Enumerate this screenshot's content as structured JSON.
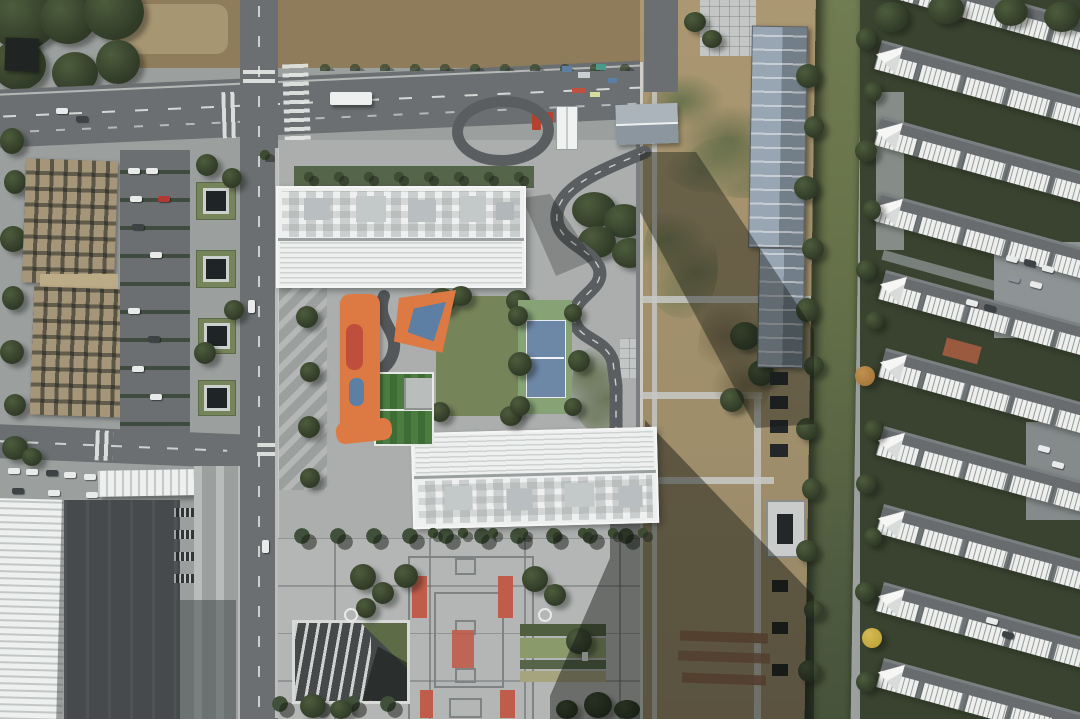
{
  "meta": {
    "type": "aerial-drone-photograph",
    "orientation": "top-down (nadir)",
    "description": "Top-down aerial photograph of a school campus flanked by city roads. Center: two long white slab buildings with louvered roofs; between them a courtyard with an orange playground, a small artificial-turf football pitch, a lawn and a blue tennis court. South: a large paved plaza with dark grid paving, red stone accents and a striped sunken amphitheatre. West: a road, a parking lot, a demolished tan building and a white-roofed hall. East: a fenced dirt construction strip with long shadows, blue-grey sheds, a green canal, and diagonal rows of white-and-grey terraced residential houses among dark trees."
  },
  "palette": {
    "walk": "#9b9f9e",
    "asphalt": "#6b6f71",
    "road_dark": "#5a5e60",
    "line": "#e7e9e7",
    "pave": "#abaead",
    "pave_light": "#c3c6c4",
    "plaza": "#b4b6b5",
    "plaza_line": "#7f8384",
    "plaza_red": "#c05c4a",
    "white_roof": "#eef0ef",
    "louver": "#cdd2d1",
    "dirt": "#a3906c",
    "dirt_light": "#bcab87",
    "field": "#8f7c5a",
    "tan_ruin": "#a59579",
    "tree": "#2f3a27",
    "tree_hi": "#4d5c3c",
    "hedge": "#556549",
    "lawn": "#76845a",
    "lawn_dry": "#a6a37f",
    "turf": "#3e6c35",
    "turf_hi": "#4c7c40",
    "court_green": "#87a375",
    "court_blue": "#6d87a6",
    "orange": "#dd7a44",
    "play_red": "#bf4f3c",
    "play_blue": "#5d7fa3",
    "water_top": "#717c52",
    "water_bot": "#46523a",
    "shed": "#98a6b3",
    "shed_dark": "#727e88",
    "resi_roof": "#686c6f",
    "resi_white": "#edefed",
    "dark_yard": "#464a4c",
    "black_roof": "#202422",
    "concrete": "#c7c9c7",
    "red_container": "#b5412f",
    "car_white": "#e9ebea",
    "car_dark": "#3d4245",
    "car_red": "#b03a32",
    "bush_orange": "#a8793c",
    "bush_yellow": "#c2a43c",
    "debris_red": "#8a5f45",
    "shadow": "#10140f"
  },
  "scene": {
    "landmarks": [
      "north-school-building",
      "south-school-building",
      "tennis-court",
      "football-pitch",
      "orange-playground",
      "central-lawn",
      "south-plaza",
      "sunken-amphitheatre",
      "demolished-building",
      "west-parking-lot",
      "white-hall",
      "construction-strip",
      "canal",
      "canal-sheds",
      "residential-rows",
      "main-road-north",
      "main-road-west",
      "turnaround-loop",
      "bus-shelter"
    ]
  }
}
